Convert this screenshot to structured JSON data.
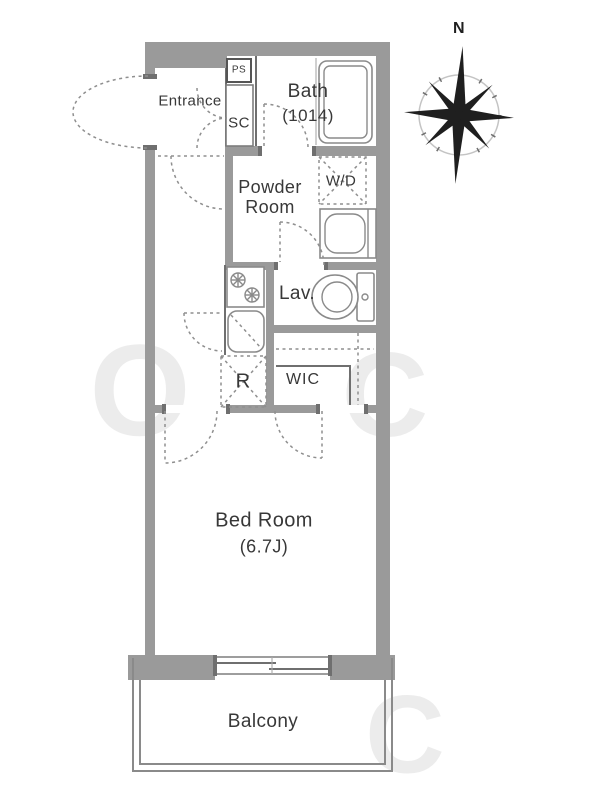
{
  "rooms": {
    "entrance": {
      "label": "Entrance"
    },
    "ps": {
      "label": "PS"
    },
    "sc": {
      "label": "SC"
    },
    "bath": {
      "label": "Bath",
      "size": "(1014)"
    },
    "powder_room": {
      "label": "Powder Room"
    },
    "wd": {
      "label": "W/D"
    },
    "lav": {
      "label": "Lav."
    },
    "refrigerator": {
      "label": "R"
    },
    "wic": {
      "label": "WIC"
    },
    "bedroom": {
      "label": "Bed Room",
      "size": "(6.7J)"
    },
    "balcony": {
      "label": "Balcony"
    }
  },
  "compass": {
    "north": "N"
  },
  "watermark": {
    "w1": "O",
    "w2": "C",
    "w3": "C"
  },
  "colors": {
    "wall": "#9a9a9a",
    "line": "#6f6f6f",
    "dash": "#8f8f8f",
    "text": "#383838"
  }
}
